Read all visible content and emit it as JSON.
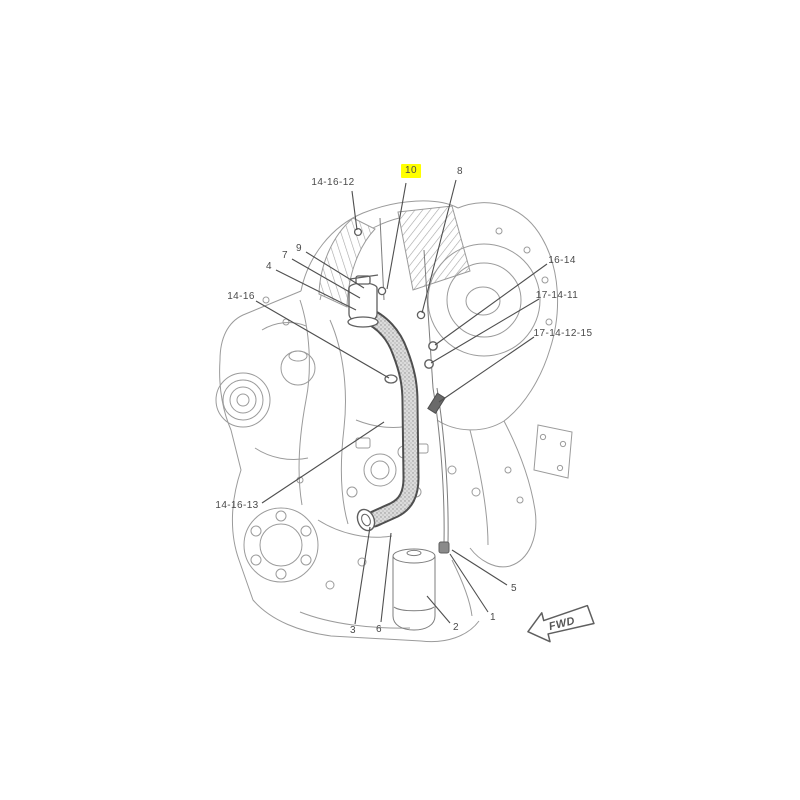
{
  "diagram": {
    "type": "engine-parts-exploded-view",
    "highlight_color": "#ffff00",
    "line_color": "#9b9b9b",
    "leader_color": "#4f4f4f",
    "fwd_label": "FWD",
    "callouts": [
      {
        "label": "14-16-12",
        "highlighted": false
      },
      {
        "label": "10",
        "highlighted": true
      },
      {
        "label": "8",
        "highlighted": false
      },
      {
        "label": "9",
        "highlighted": false
      },
      {
        "label": "7",
        "highlighted": false
      },
      {
        "label": "4",
        "highlighted": false
      },
      {
        "label": "14-16",
        "highlighted": false
      },
      {
        "label": "16-14",
        "highlighted": false
      },
      {
        "label": "17-14-11",
        "highlighted": false
      },
      {
        "label": "17-14-12-15",
        "highlighted": false
      },
      {
        "label": "14-16-13",
        "highlighted": false
      },
      {
        "label": "3",
        "highlighted": false
      },
      {
        "label": "6",
        "highlighted": false
      },
      {
        "label": "2",
        "highlighted": false
      },
      {
        "label": "1",
        "highlighted": false
      },
      {
        "label": "5",
        "highlighted": false
      }
    ]
  }
}
